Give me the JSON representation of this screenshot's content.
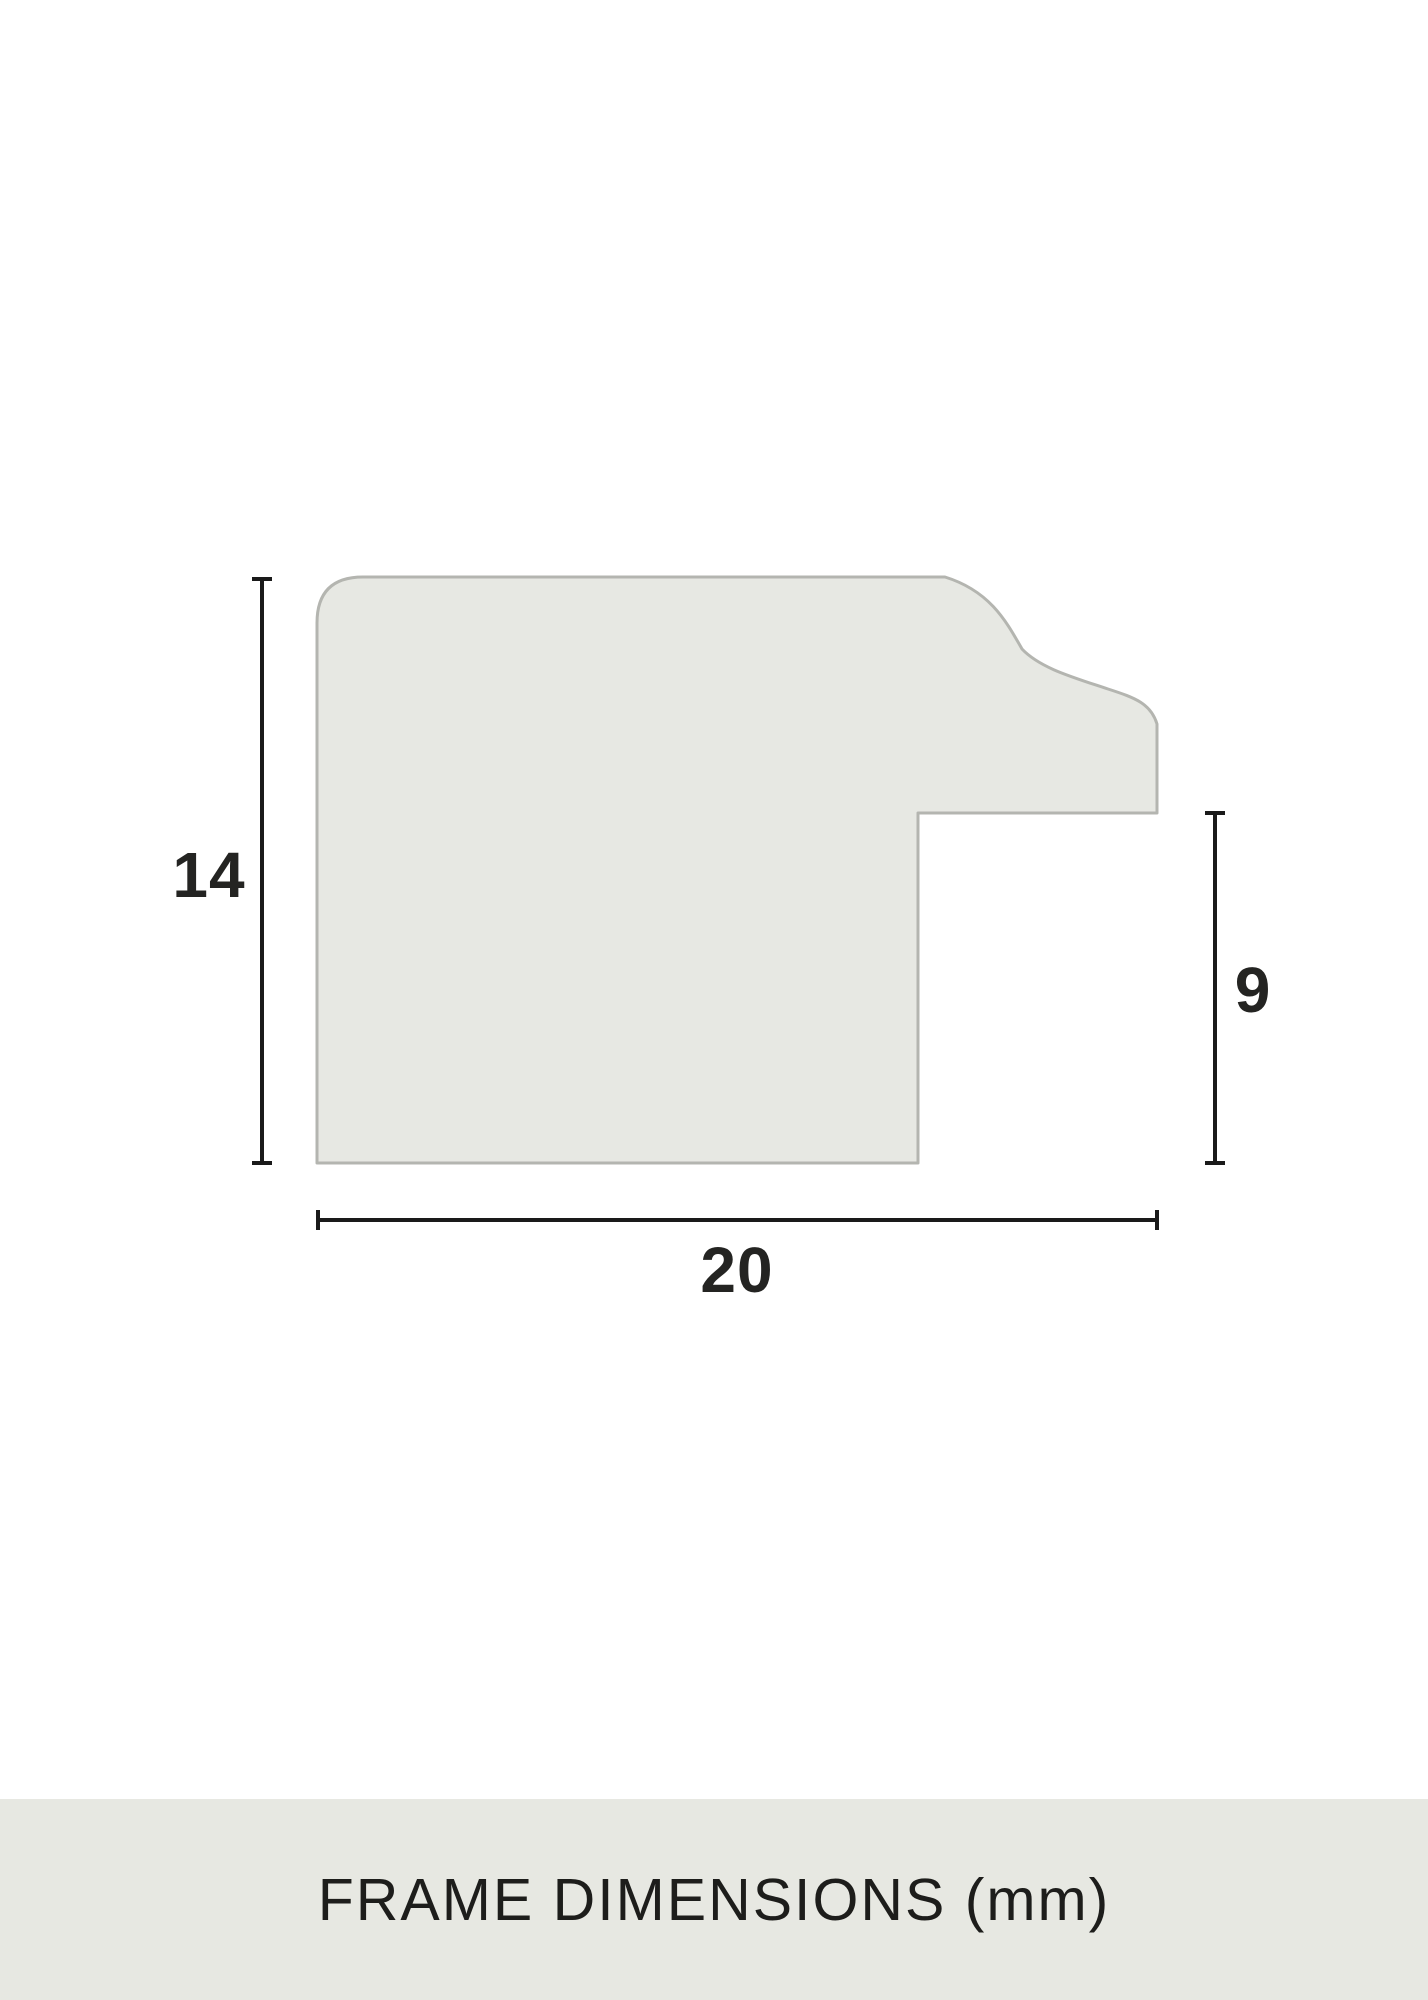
{
  "diagram": {
    "type": "frame-moulding-cross-section",
    "dimensions": {
      "height": "14",
      "width": "20",
      "rebate": "9"
    }
  },
  "caption": {
    "text": "FRAME DIMENSIONS (mm)"
  },
  "colors": {
    "shape-fill": "#e7e8e3",
    "shape-stroke": "#b4b5b0",
    "dim-line": "#1a1a1a",
    "label-text": "#242422",
    "banner-bg": "#e7e8e2",
    "banner-text": "#1d1d1b",
    "page-bg": "#ffffff"
  }
}
